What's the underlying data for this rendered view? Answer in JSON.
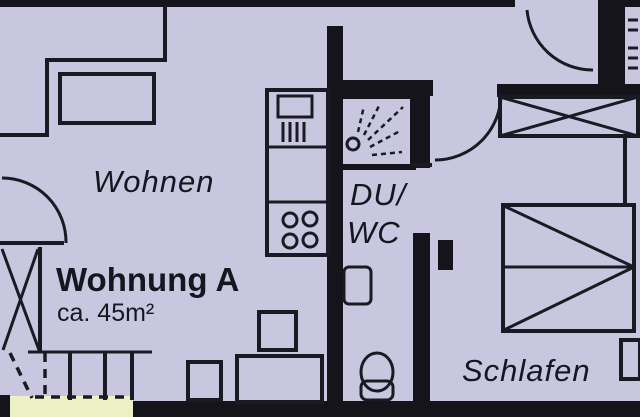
{
  "plan": {
    "title": "Wohnung A",
    "area": "ca. 45m²",
    "rooms": {
      "living": "Wohnen",
      "bath_line1": "DU/",
      "bath_line2": "WC",
      "bedroom": "Schlafen"
    }
  },
  "colors": {
    "floor": "#c9c7e0",
    "wall": "#14141a",
    "outside": "#edf0c5",
    "line": "#1a1a22",
    "text": "#16161e"
  }
}
